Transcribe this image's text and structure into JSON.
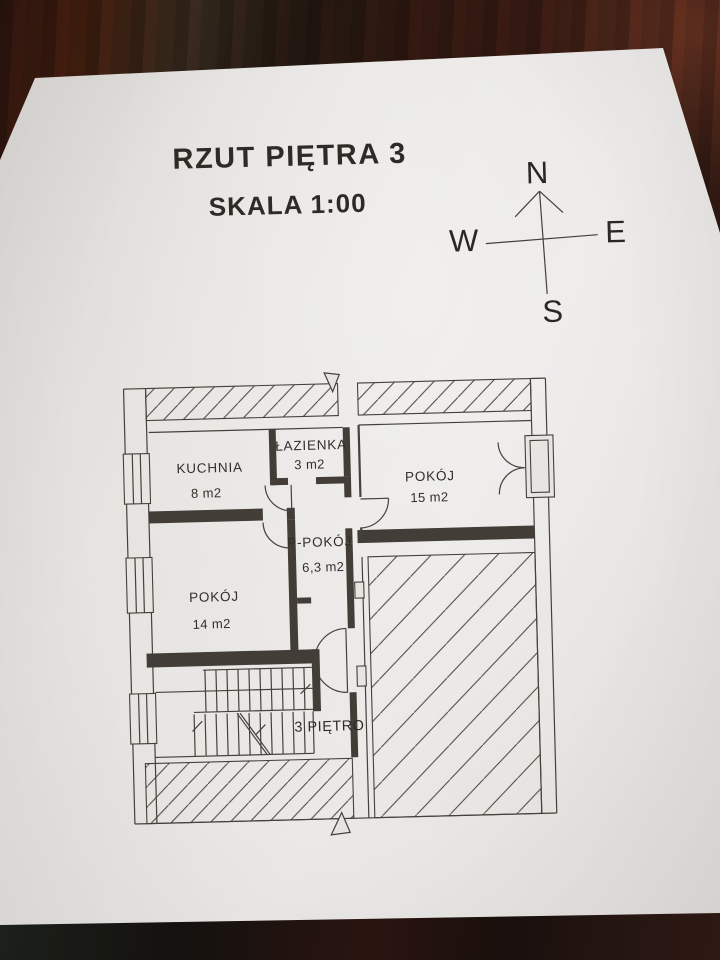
{
  "header": {
    "title": "RZUT PIĘTRA 3",
    "scale": "SKALA 1:00"
  },
  "compass": {
    "n": "N",
    "e": "E",
    "s": "S",
    "w": "W"
  },
  "plan": {
    "rooms": [
      {
        "id": "kuchnia",
        "name": "KUCHNIA",
        "area": "8 m2"
      },
      {
        "id": "lazienka",
        "name": "ŁAZIENKA",
        "area": "3 m2"
      },
      {
        "id": "pokoj-15",
        "name": "POKÓJ",
        "area": "15 m2"
      },
      {
        "id": "p-pokoj",
        "name": "P-POKÓJ",
        "area": "6,3 m2"
      },
      {
        "id": "pokoj-14",
        "name": "POKÓJ",
        "area": "14 m2"
      }
    ],
    "stair_label": "3 PIĘTRO"
  },
  "colors": {
    "paper": "#e7e5e2",
    "ink": "#45403a",
    "wood_dark": "#171210",
    "wood_red": "#47200f"
  }
}
